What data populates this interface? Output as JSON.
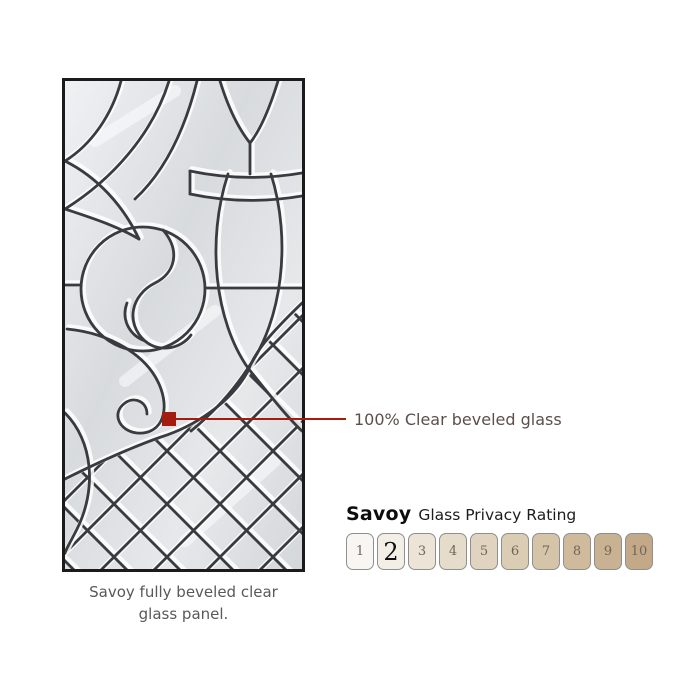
{
  "glass_panel": {
    "caption": {
      "line1": "Savoy fully beveled clear",
      "line2": "glass panel."
    },
    "frame_color": "#1b1b1b",
    "lead_line_color": "#383b40",
    "glass_base_color": "#dcdfe2",
    "glass_highlight_color": "#f2f4f5"
  },
  "callout": {
    "label": "100% Clear beveled glass",
    "line_color": "#a41c0f",
    "text_color": "#5c4f4b"
  },
  "privacy_rating": {
    "heading_product": "Savoy",
    "heading_text": "Glass Privacy Rating",
    "selected_value": 2,
    "scale_border_color": "#8f8f8f",
    "levels": [
      {
        "value": 1,
        "color": "#f8f6f2"
      },
      {
        "value": 2,
        "color": "#f3eee6"
      },
      {
        "value": 3,
        "color": "#ece4d6"
      },
      {
        "value": 4,
        "color": "#e6dcca"
      },
      {
        "value": 5,
        "color": "#e0d4c0"
      },
      {
        "value": 6,
        "color": "#dbccb4"
      },
      {
        "value": 7,
        "color": "#d5c4a8"
      },
      {
        "value": 8,
        "color": "#cfbb9c"
      },
      {
        "value": 9,
        "color": "#c9b291"
      },
      {
        "value": 10,
        "color": "#c3a987"
      }
    ]
  }
}
